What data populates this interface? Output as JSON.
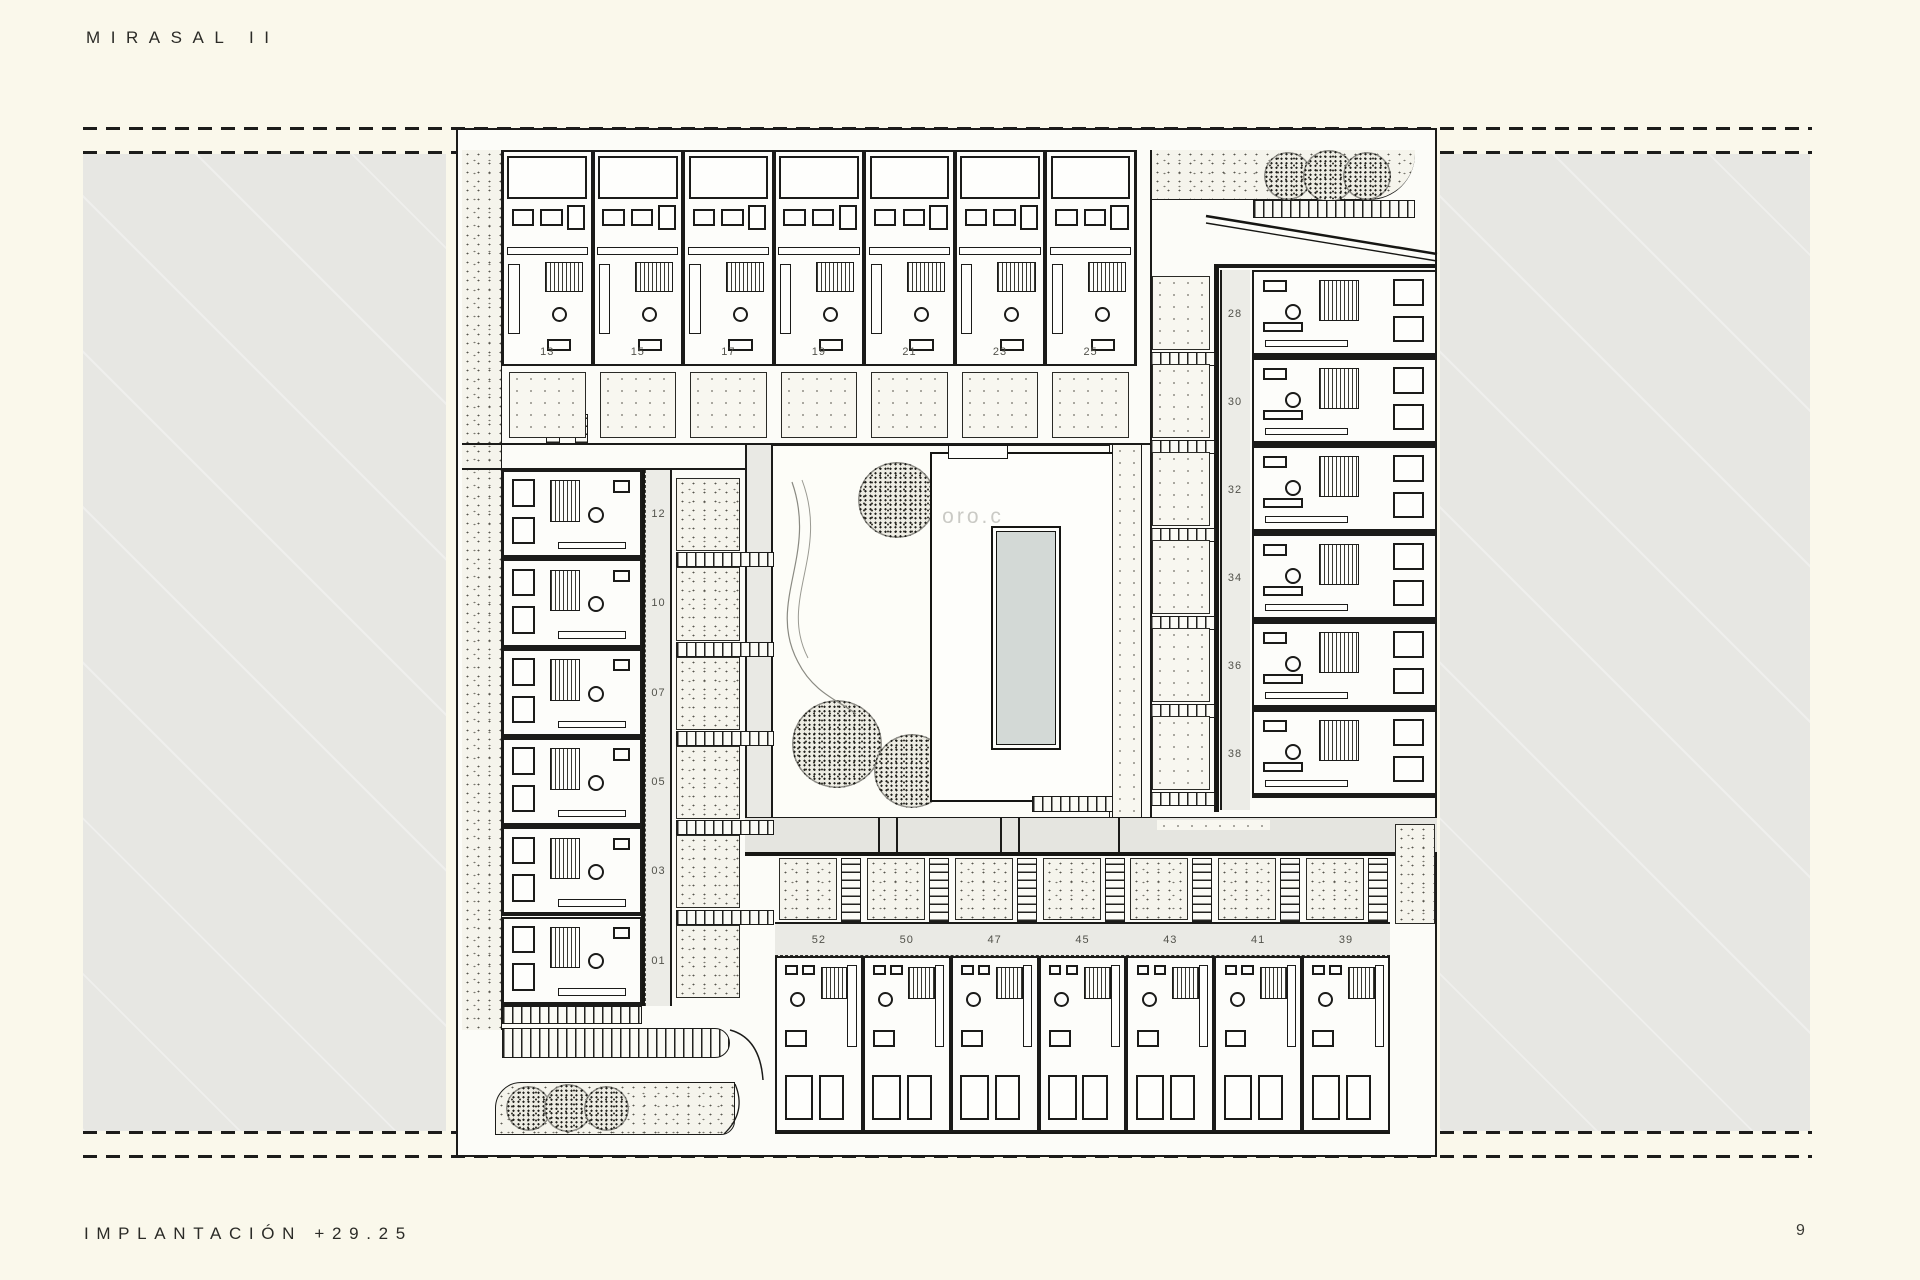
{
  "document": {
    "title": "MIRASAL II",
    "footer_label": "IMPLANTACIÓN +29.25",
    "page_number": "9",
    "watermark_text": "oro.c"
  },
  "site_plan": {
    "top_row_units": [
      "13",
      "15",
      "17",
      "19",
      "21",
      "23",
      "25"
    ],
    "right_column_units": [
      "28",
      "30",
      "32",
      "34",
      "36",
      "38"
    ],
    "left_column_units": [
      "12",
      "10",
      "07",
      "05",
      "03",
      "01"
    ],
    "bottom_row_units": [
      "52",
      "50",
      "47",
      "45",
      "43",
      "41",
      "39"
    ]
  },
  "colors": {
    "paper": "#FAF8EB",
    "parcel_gray": "#E7E7E3",
    "plan_background": "#FCFCF8",
    "label_band": "#EAEAE5",
    "ink": "#1B1B19",
    "pool_water": "#D3D9D6"
  }
}
